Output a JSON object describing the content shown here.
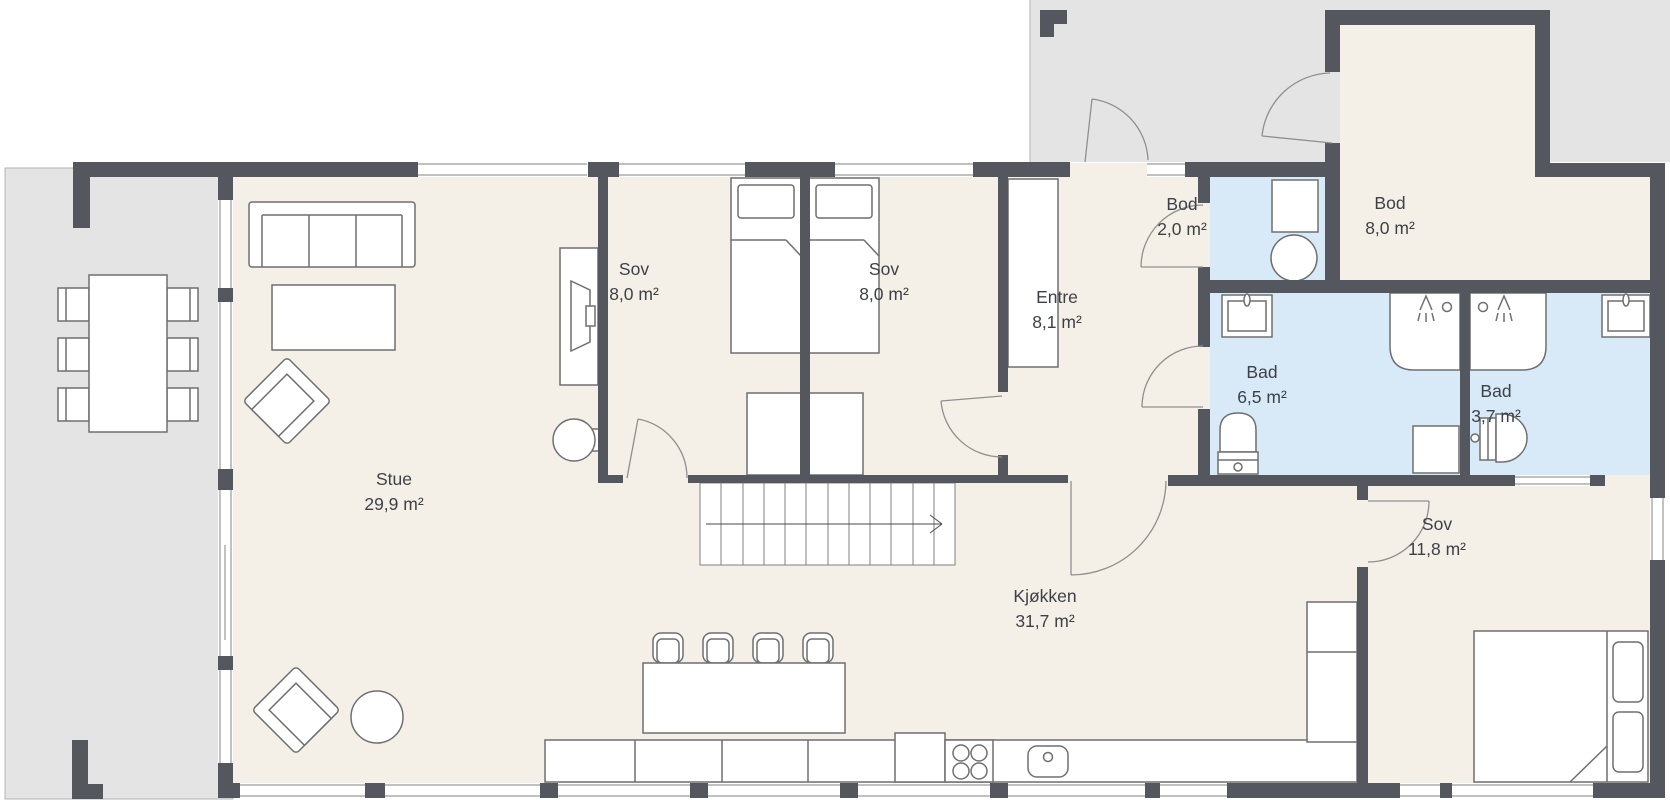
{
  "plan": {
    "title": "Floor plan",
    "rooms": [
      {
        "name": "Stue",
        "area": "29,9 m²"
      },
      {
        "name": "Sov",
        "area": "8,0 m²"
      },
      {
        "name": "Sov",
        "area": "8,0 m²"
      },
      {
        "name": "Entre",
        "area": "8,1 m²"
      },
      {
        "name": "Bod",
        "area": "2,0 m²"
      },
      {
        "name": "Bod",
        "area": "8,0 m²"
      },
      {
        "name": "Bad",
        "area": "6,5 m²"
      },
      {
        "name": "Bad",
        "area": "3,7 m²"
      },
      {
        "name": "Kjøkken",
        "area": "31,7 m²"
      },
      {
        "name": "Sov",
        "area": "11,8 m²"
      }
    ],
    "fixtures": [
      "sofa",
      "coffee-table",
      "armchair",
      "side-table",
      "tv-bench",
      "tv",
      "dining-table",
      "dining-chair",
      "single-bed",
      "dresser",
      "wardrobe",
      "stairs",
      "stairs-direction-arrow",
      "kitchen-island",
      "bar-stool",
      "kitchen-counter",
      "fridge",
      "cooktop",
      "kitchen-sink",
      "double-bed",
      "pillow",
      "bathroom-sink",
      "shower",
      "toilet",
      "wall-hung-toilet",
      "washing-machine",
      "water-heater"
    ],
    "colors": {
      "wall": "#54585e",
      "floor": "#f4f0e7",
      "wet_room_floor": "#d8eaf7",
      "outside": "#e4e4e4",
      "furniture_line": "#6f6f6f"
    }
  }
}
